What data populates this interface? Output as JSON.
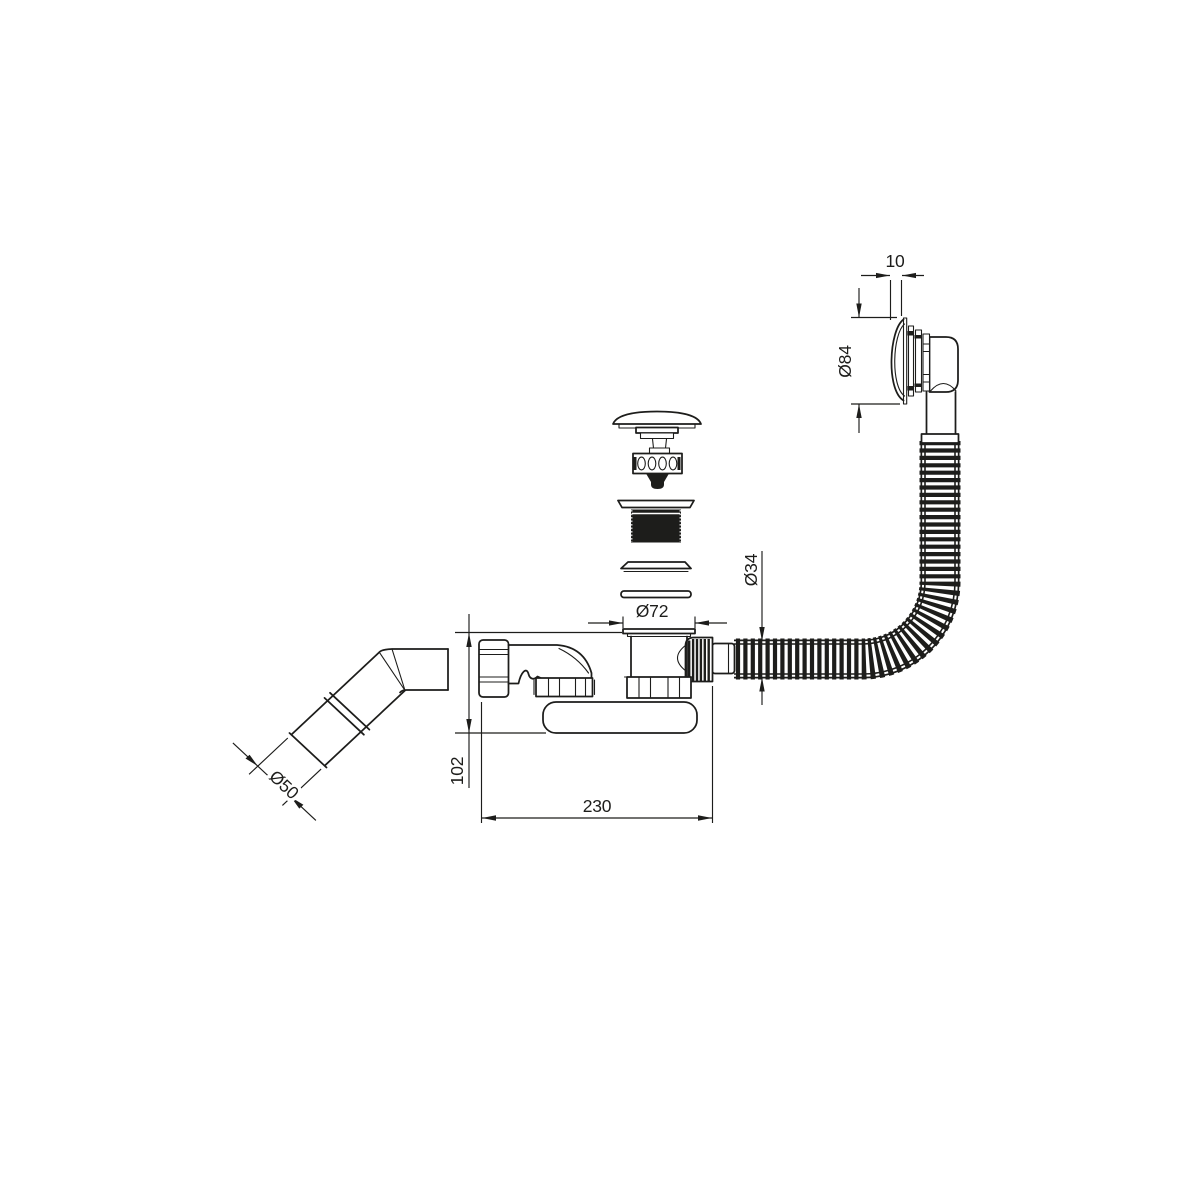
{
  "colors": {
    "line": "#1d1d1b",
    "background": "#ffffff"
  },
  "dimensions": {
    "overflow_face_depth": {
      "label": "10"
    },
    "overflow_diameter": {
      "label": "Ø84"
    },
    "hose_diameter": {
      "label": "Ø34"
    },
    "drain_flange_diameter": {
      "label": "Ø72"
    },
    "siphon_height": {
      "label": "102"
    },
    "siphon_length": {
      "label": "230"
    },
    "outlet_diameter": {
      "label": "Ø50"
    }
  }
}
